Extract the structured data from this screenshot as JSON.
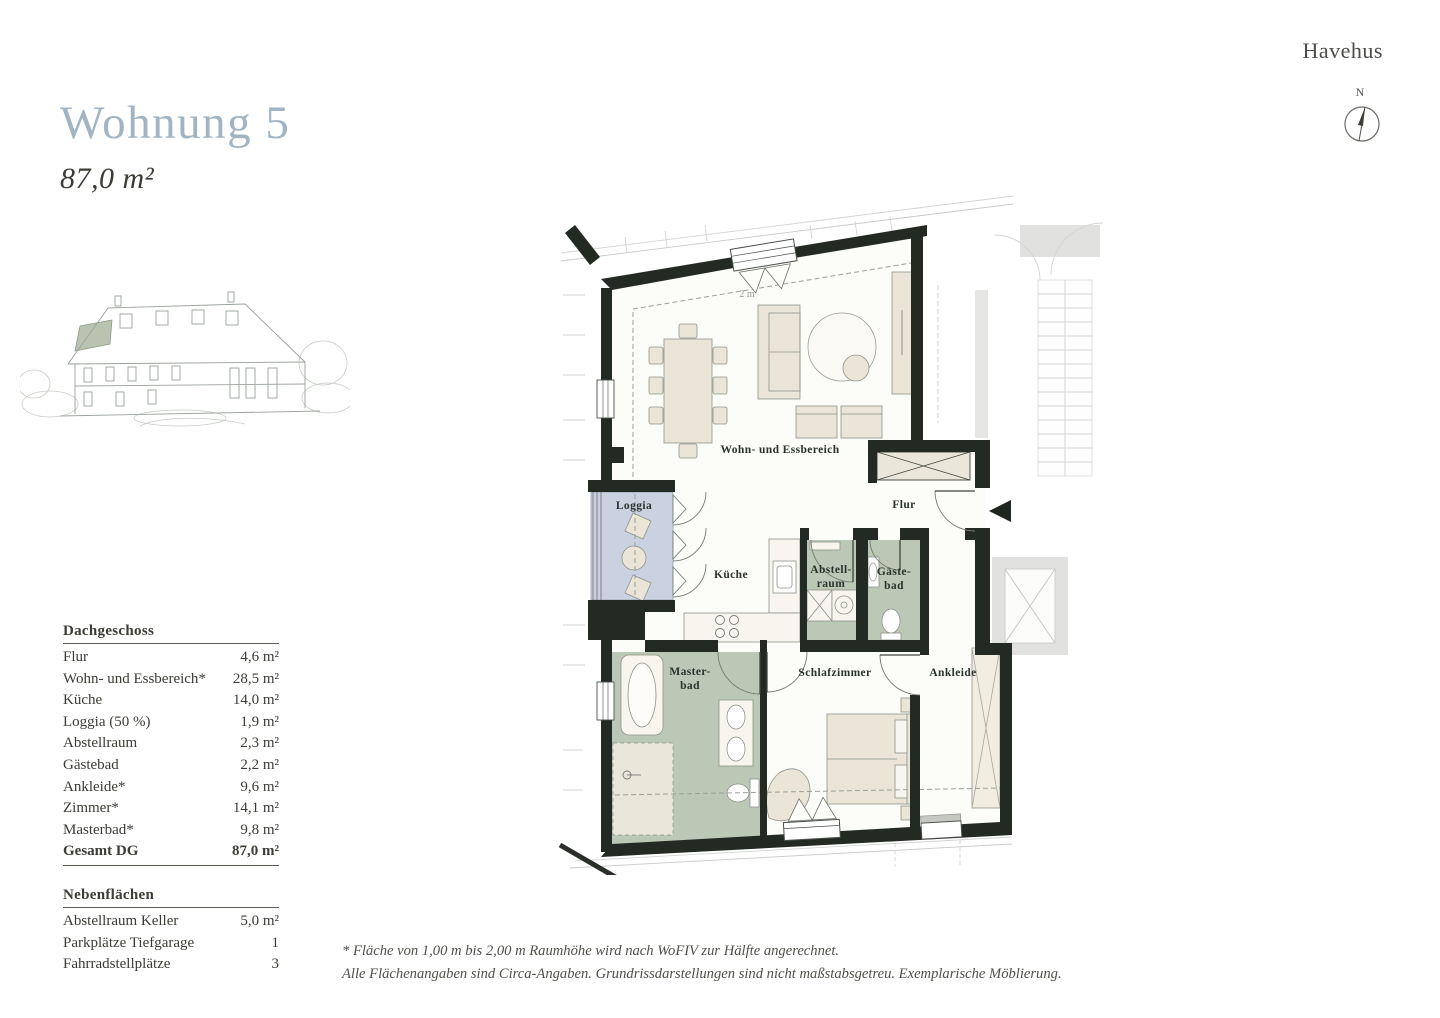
{
  "brand": "Havehus",
  "header": {
    "title": "Wohnung 5",
    "total_area": "87,0 m²"
  },
  "compass": {
    "north_label": "N"
  },
  "plan": {
    "labels": {
      "living": "Wohn- und Essbereich",
      "flur": "Flur",
      "loggia": "Loggia",
      "kueche": "Küche",
      "abstell1": "Abstell-",
      "abstell2": "raum",
      "gaeste1": "Gäste-",
      "gaeste2": "bad",
      "master1": "Master-",
      "master2": "bad",
      "schlaf": "Schlafzimmer",
      "ankleide": "Ankleide",
      "height_line": "2 m"
    },
    "colors": {
      "wall": "#232a24",
      "loggia_fill": "#cad2e2",
      "bath_fill": "#bcc8b6",
      "furniture_fill": "#eae5d7",
      "floor_fill": "#fcfcf8",
      "outside_gray": "#e1e2e0"
    }
  },
  "area_table": {
    "header": "Dachgeschoss",
    "rows": [
      {
        "label": "Flur",
        "value": "4,6 m²"
      },
      {
        "label": "Wohn- und Essbereich*",
        "value": "28,5 m²"
      },
      {
        "label": "Küche",
        "value": "14,0 m²"
      },
      {
        "label": "Loggia (50 %)",
        "value": "1,9 m²"
      },
      {
        "label": "Abstellraum",
        "value": "2,3 m²"
      },
      {
        "label": "Gästebad",
        "value": "2,2 m²"
      },
      {
        "label": "Ankleide*",
        "value": "9,6 m²"
      },
      {
        "label": "Zimmer*",
        "value": "14,1 m²"
      },
      {
        "label": "Masterbad*",
        "value": "9,8 m²"
      }
    ],
    "total": {
      "label": "Gesamt DG",
      "value": "87,0 m²"
    }
  },
  "secondary_table": {
    "header": "Nebenflächen",
    "rows": [
      {
        "label": "Abstellraum Keller",
        "value": "5,0 m²"
      },
      {
        "label": "Parkplätze Tiefgarage",
        "value": "1"
      },
      {
        "label": "Fahrradstellplätze",
        "value": "3"
      }
    ]
  },
  "footnotes": {
    "line1": "* Fläche von 1,00 m bis 2,00 m Raumhöhe wird nach WoFIV zur Hälfte angerechnet.",
    "line2": "Alle Flächenangaben sind Circa-Angaben. Grundrissdarstellungen sind nicht maßstabsgetreu. Exemplarische Möblierung."
  }
}
